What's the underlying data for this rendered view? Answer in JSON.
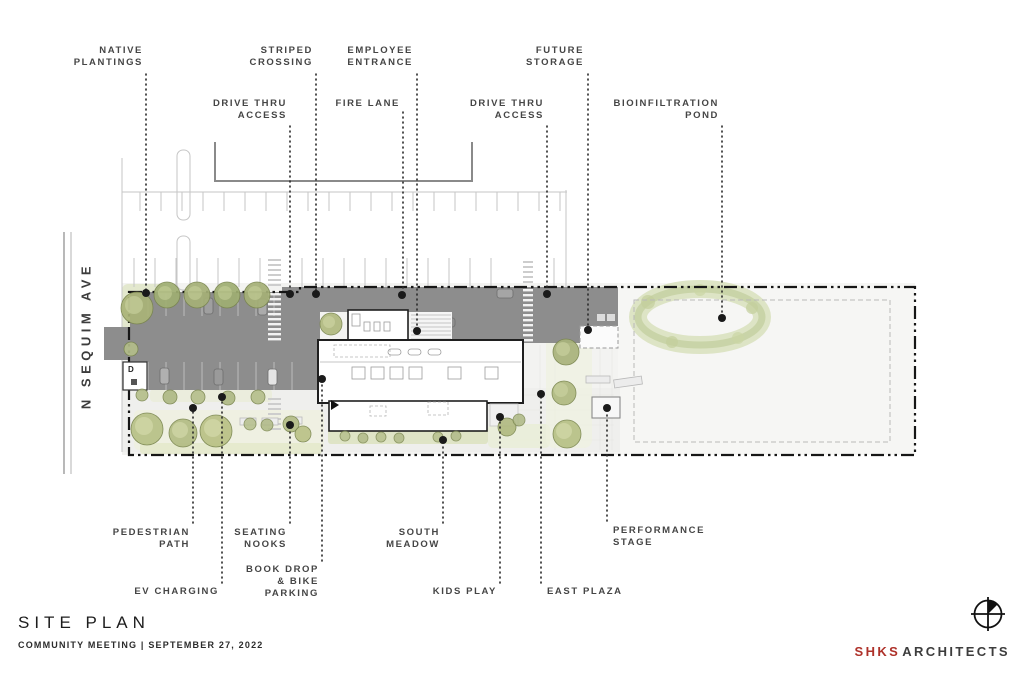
{
  "title_block": {
    "title": "SITE PLAN",
    "subtitle": "COMMUNITY MEETING  |  SEPTEMBER 27, 2022"
  },
  "brand": {
    "primary": "SHKS",
    "secondary": "ARCHITECTS",
    "accent_color": "#ae3129",
    "logo": "crosshair-survey-mark-icon"
  },
  "street": {
    "name": "N SEQUIM AVE"
  },
  "callouts": {
    "native_plantings": "NATIVE\nPLANTINGS",
    "striped_crossing": "STRIPED\nCROSSING",
    "employee_entrance": "EMPLOYEE\nENTRANCE",
    "future_storage": "FUTURE\nSTORAGE",
    "drive_thru_access_west": "DRIVE THRU\nACCESS",
    "fire_lane": "FIRE LANE",
    "drive_thru_access_east": "DRIVE THRU\nACCESS",
    "bioinfiltration_pond": "BIOINFILTRATION\nPOND",
    "pedestrian_path": "PEDESTRIAN\nPATH",
    "seating_nooks": "SEATING\nNOOKS",
    "south_meadow": "SOUTH\nMEADOW",
    "performance_stage": "PERFORMANCE\nSTAGE",
    "ev_charging": "EV CHARGING",
    "book_drop_bike_parking": "BOOK DROP\n& BIKE\nPARKING",
    "kids_play": "KIDS PLAY",
    "east_plaza": "EAST PLAZA"
  },
  "colors": {
    "road_gray": "#8d8d8d",
    "tree_green": "#a9b37b",
    "pond_green": "#ccd6a8",
    "label_gray": "#454545",
    "boundary_black": "#161616"
  }
}
